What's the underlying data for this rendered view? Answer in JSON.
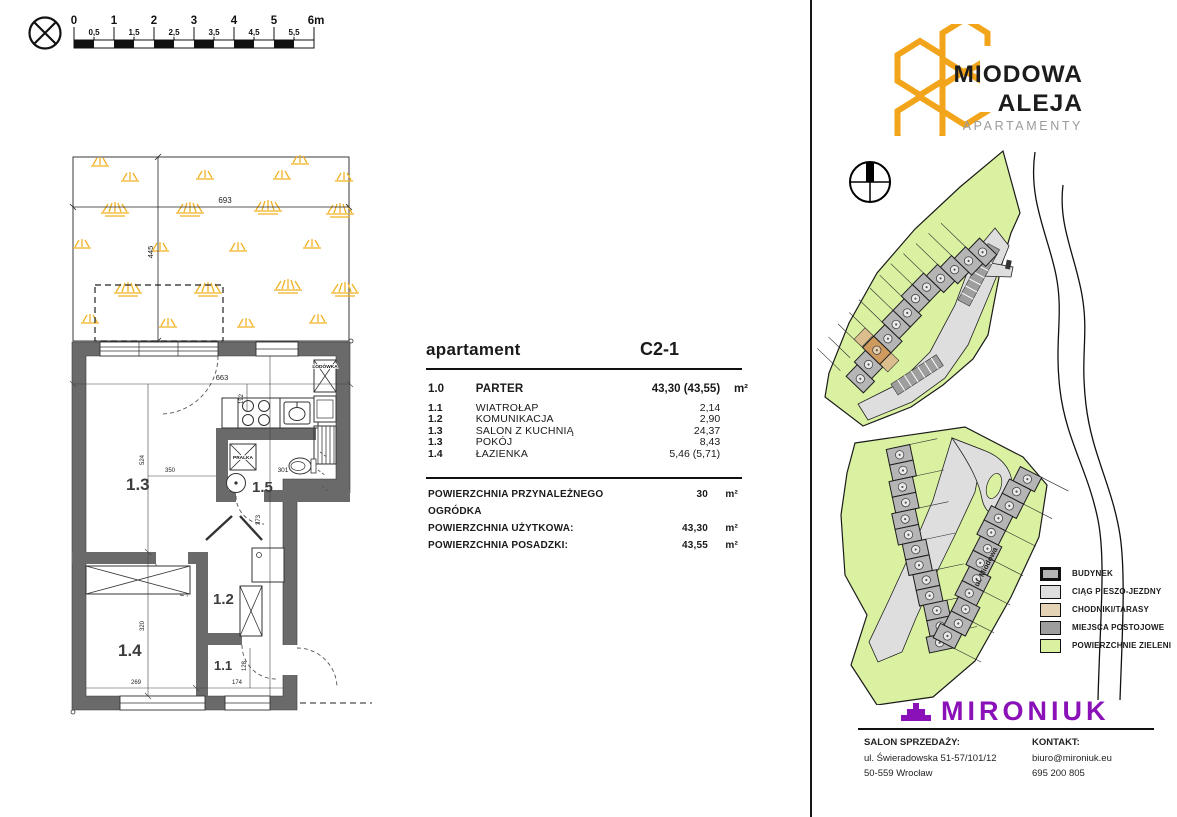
{
  "scale_bar": {
    "majors": [
      "0",
      "1",
      "2",
      "3",
      "4",
      "5",
      "6m"
    ],
    "minors": [
      "0,5",
      "1,5",
      "2,5",
      "3,5",
      "4,5",
      "5,5"
    ]
  },
  "brand": {
    "line1": "MIODOWA",
    "line2": "ALEJA",
    "line3": "APARTAMENTY",
    "accent": "#F2A51B",
    "text_dark": "#1c1c1e",
    "text_gray": "#9b9b9b"
  },
  "apartment_table": {
    "title": "apartament",
    "unit_code": "C2-1",
    "rows": [
      {
        "code": "1.0",
        "name": "PARTER",
        "value": "43,30 (43,55)",
        "unit": "m²"
      },
      {
        "code": "1.1",
        "name": "WIATROŁAP",
        "value": "2,14",
        "unit": ""
      },
      {
        "code": "1.2",
        "name": "KOMUNIKACJA",
        "value": "2,90",
        "unit": ""
      },
      {
        "code": "1.3",
        "name": "SALON Z KUCHNIĄ",
        "value": "24,37",
        "unit": ""
      },
      {
        "code": "1.3",
        "name": "POKÓJ",
        "value": "8,43",
        "unit": ""
      },
      {
        "code": "1.4",
        "name": "ŁAZIENKA",
        "value": "5,46 (5,71)",
        "unit": ""
      }
    ],
    "summary": [
      {
        "label": "POWIERZCHNIA PRZYNALEŻNEGO OGRÓDKA",
        "value": "30",
        "unit": "m²"
      },
      {
        "label": "POWIERZCHNIA UŻYTKOWA:",
        "value": "43,30",
        "unit": "m²"
      },
      {
        "label": "POWIERZCHNIA POSADZKI:",
        "value": "43,55",
        "unit": "m²"
      }
    ]
  },
  "floor_plan": {
    "rooms": {
      "living": "1.3",
      "bath": "1.5",
      "hall": "1.2",
      "entry": "1.1",
      "bedroom": "1.4"
    },
    "fixtures": {
      "fridge": "LODÓWKA",
      "washer": "PRALKA"
    },
    "dims": {
      "garden_w": "693",
      "garden_h": "445",
      "interior_w": "663",
      "kitchen": "192",
      "living_h": "524",
      "living_w": "350",
      "bath_w": "301",
      "hall_h": "373",
      "bedroom_h": "320",
      "bedroom_w": "269",
      "entry_w": "174",
      "entry_h": "128"
    }
  },
  "site_plan": {
    "street": "ul. Miodowa",
    "highlight_color": "#cf9a5e"
  },
  "legend": {
    "items": [
      {
        "label": "BUDYNEK",
        "color": "#b5b5b5"
      },
      {
        "label": "CIĄG PIESZO-JEZDNY",
        "color": "#dedede"
      },
      {
        "label": "CHODNIKI/TARASY",
        "color": "#e4d3b5"
      },
      {
        "label": "MIEJSCA POSTOJOWE",
        "color": "#9e9e9e"
      },
      {
        "label": "POWIERZCHNIE ZIELENI",
        "color": "#d9f1a1"
      }
    ]
  },
  "footer": {
    "company": "MIRONIUK",
    "brand_color": "#8A10B8",
    "sales_title": "SALON SPRZEDAŻY:",
    "sales_address1": "ul. Świeradowska 51-57/101/12",
    "sales_address2": "50-559 Wrocław",
    "contact_title": "KONTAKT:",
    "contact_email": "biuro@mironiuk.eu",
    "contact_phone": "695 200 805"
  }
}
